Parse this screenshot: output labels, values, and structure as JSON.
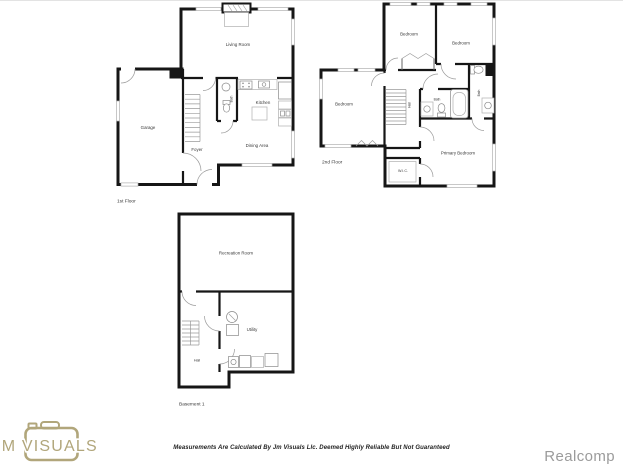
{
  "colors": {
    "wall": "#161616",
    "fixture_gray": "#8a8a8a",
    "logo_gold": "#b1a67b",
    "realcomp_gray": "#9b9b9b"
  },
  "floors": {
    "first": {
      "label": "1st Floor",
      "rooms": {
        "living_room": "Living Room",
        "garage": "Garage",
        "kitchen": "Kitchen",
        "dining_area": "Dining Area",
        "foyer": "Foyer",
        "bath": "Bath"
      }
    },
    "second": {
      "label": "2nd Floor",
      "rooms": {
        "bedroom_top_left": "Bedroom",
        "bedroom_top_right": "Bedroom",
        "bedroom_left": "Bedroom",
        "hall": "Hall",
        "bath": "Bath",
        "bath_ensuite": "Bath",
        "primary_bedroom": "Primary Bedroom",
        "wic": "W.I.C."
      }
    },
    "basement": {
      "label": "Basement 1",
      "rooms": {
        "recreation_room": "Recreation Room",
        "utility": "Utility",
        "hall": "Hall"
      }
    }
  },
  "branding": {
    "logo_text": "JM VISUALS",
    "mls": "Realcomp"
  },
  "footer": {
    "disclaimer": "Measurements Are Calculated By Jm Visuals Llc. Deemed Highly Reliable But Not Guaranteed"
  }
}
